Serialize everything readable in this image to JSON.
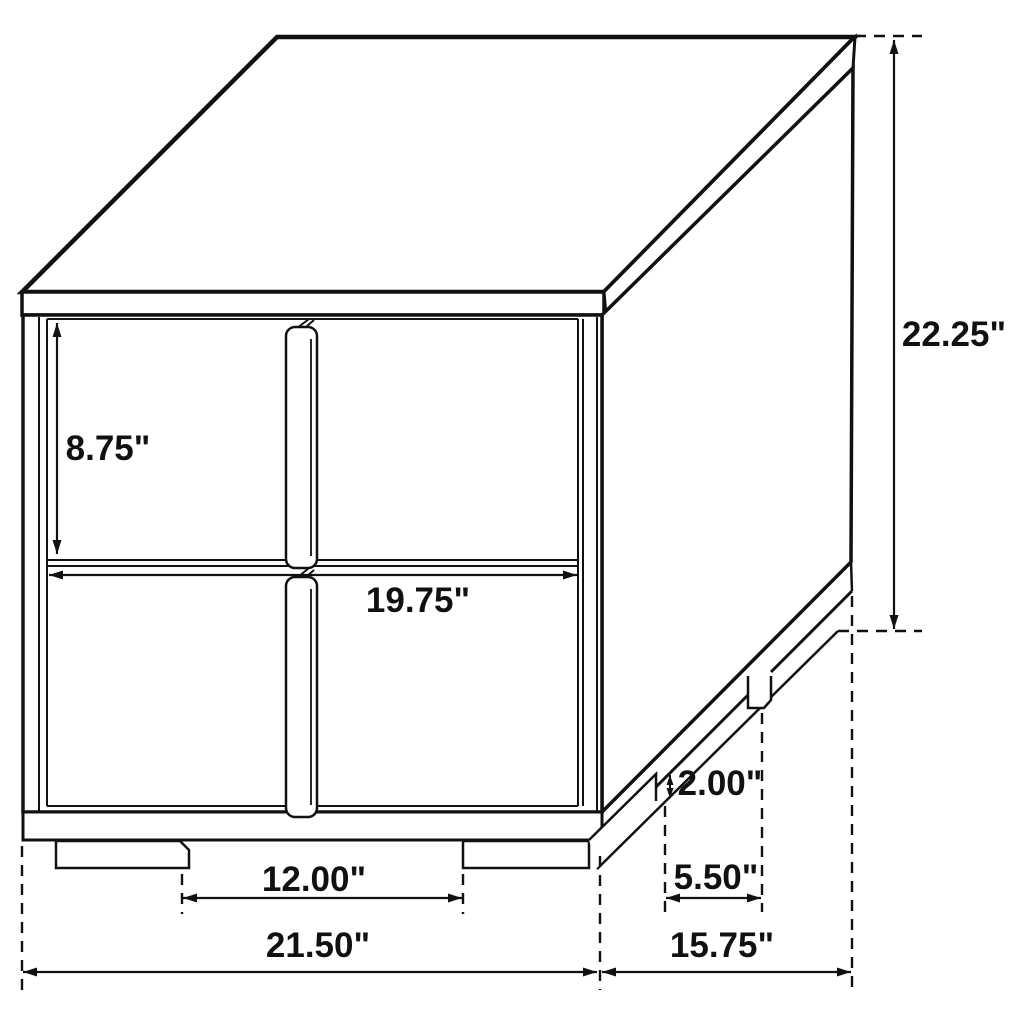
{
  "drawing": {
    "subject": "2-drawer nightstand dimensional line drawing",
    "unit": "inches",
    "colors": {
      "line": "#111111",
      "background": "#ffffff"
    },
    "dimensions": [
      {
        "id": "drawer-height",
        "value": 8.75,
        "label": "8.75\""
      },
      {
        "id": "drawer-width",
        "value": 19.75,
        "label": "19.75\""
      },
      {
        "id": "overall-height",
        "value": 22.25,
        "label": "22.25\""
      },
      {
        "id": "foot-height",
        "value": 2.0,
        "label": "2.00\""
      },
      {
        "id": "side-foot-spacing",
        "value": 5.5,
        "label": "5.50\""
      },
      {
        "id": "front-foot-spacing",
        "value": 12.0,
        "label": "12.00\""
      },
      {
        "id": "overall-width",
        "value": 21.5,
        "label": "21.50\""
      },
      {
        "id": "overall-depth",
        "value": 15.75,
        "label": "15.75\""
      }
    ]
  }
}
